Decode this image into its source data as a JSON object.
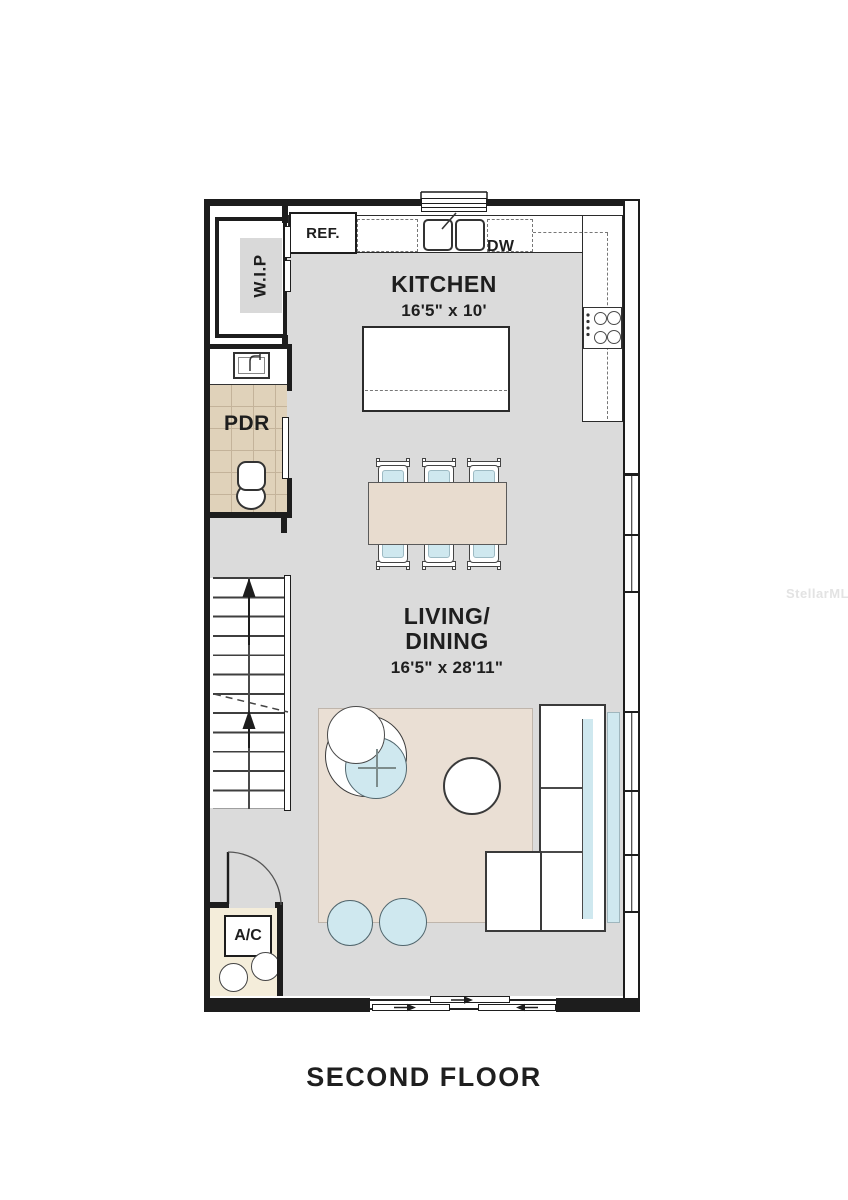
{
  "title": "SECOND FLOOR",
  "watermark": "StellarMLS",
  "rooms": {
    "kitchen": {
      "name": "KITCHEN",
      "dims": "16'5\" x 10'"
    },
    "living": {
      "line1": "LIVING/",
      "line2": "DINING",
      "dims": "16'5\" x 28'11\""
    },
    "pantry": {
      "name": "W.I.P"
    },
    "powder": {
      "name": "PDR"
    },
    "utility": {
      "name": "A/C"
    }
  },
  "appliances": {
    "refrigerator": "REF.",
    "dishwasher": "DW"
  },
  "colors": {
    "wall": "#1d1d1d",
    "floor": "#dbdbdb",
    "rug": "#eadfd4",
    "table": "#e8dccf",
    "accent": "#cfe8ef",
    "tile": "#e0d2ba",
    "tile_line": "#c4b39a",
    "cream": "#f4edda"
  }
}
